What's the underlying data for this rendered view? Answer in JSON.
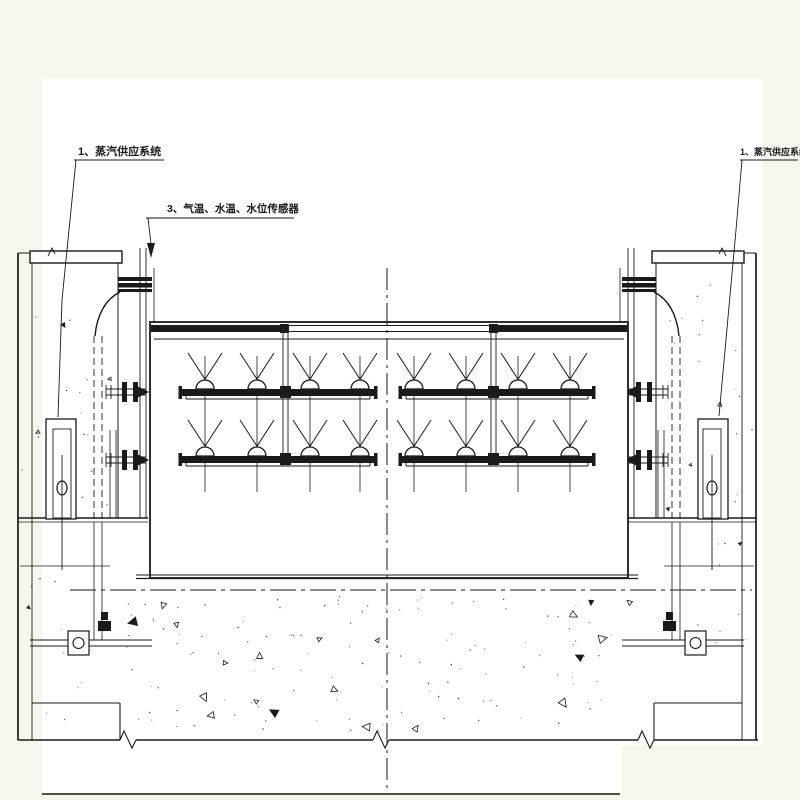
{
  "colors": {
    "background": "#f4f7ec",
    "paper": "#ffffff",
    "ink": "#1a1a1a"
  },
  "labels": {
    "steam_supply_left": "1、蒸汽供应系统",
    "sensors": "3、气温、水温、水位传感器",
    "steam_supply_right": "1、蒸汽供应系统"
  }
}
